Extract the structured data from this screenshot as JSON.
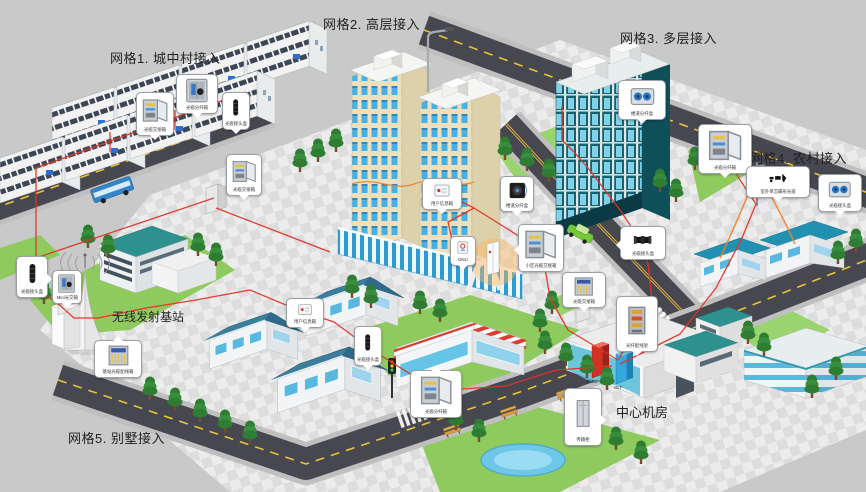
{
  "grid_labels": [
    "网格1. 城中村接入",
    "网格2. 高层接入",
    "网格3. 多层接入",
    "网格4. 农村接入",
    "网格5. 别墅接入"
  ],
  "sites": {
    "wireless_base_station": "无线发射基站",
    "central_office": "中心机房"
  },
  "equipment_tags": {
    "omdf": "OMDF",
    "olt": "OLT"
  },
  "callouts": [
    {
      "label": "光缆交接箱",
      "icon": "open-cabinet-icon"
    },
    {
      "label": "光缆分纤箱",
      "icon": "cabinet-icon"
    },
    {
      "label": "光缆接头盒",
      "icon": "splice-closure-vertical-icon"
    },
    {
      "label": "光缆交接箱",
      "icon": "open-cabinet-icon"
    },
    {
      "label": "光缆接头盒",
      "icon": "splice-closure-vertical-icon"
    },
    {
      "label": "Mini光交箱",
      "icon": "cabinet-icon"
    },
    {
      "label": "基站光缆配线箱",
      "icon": "rack-icon"
    },
    {
      "label": "用户信息箱",
      "icon": "flat-box-icon"
    },
    {
      "label": "ONU",
      "icon": "onu-icon"
    },
    {
      "label": "楼道分纤盒",
      "icon": "cable-reel-icon"
    },
    {
      "label": "小区光缆交接箱",
      "icon": "open-cabinet-icon"
    },
    {
      "label": "光缆交接箱",
      "icon": "fiber-cabinet-icon"
    },
    {
      "label": "光缆接头盒",
      "icon": "splice-closure-horizontal-icon"
    },
    {
      "label": "楼道分纤盒",
      "icon": "spool-box-icon"
    },
    {
      "label": "光缆分纤箱",
      "icon": "open-cabinet-icon"
    },
    {
      "label": "室外单芯蝶形光缆",
      "icon": "aerial-fittings-icon"
    },
    {
      "label": "光缆接头盒",
      "icon": "spool-box-icon"
    },
    {
      "label": "用户信息箱",
      "icon": "flat-box-icon"
    },
    {
      "label": "光缆接头盒",
      "icon": "splice-closure-vertical-icon"
    },
    {
      "label": "光缆分纤箱",
      "icon": "open-cabinet-icon"
    },
    {
      "label": "光纤配线架",
      "icon": "fiber-frame-icon"
    },
    {
      "label": "传输柜",
      "icon": "tall-cabinet-icon"
    }
  ],
  "colors": {
    "background": "#c9c9c9",
    "road_asphalt": "#474750",
    "road_marking_yellow": "#e8c33a",
    "fiber_red": "#e23426",
    "drop_cable_orange": "#f08030",
    "roof_teal": "#2f9292",
    "tower_cream": "#ece0bf",
    "window_blue": "#49b0e3",
    "lawn_green": "#8fca5f",
    "omdf_red": "#d03226",
    "olt_blue": "#34a8de"
  }
}
